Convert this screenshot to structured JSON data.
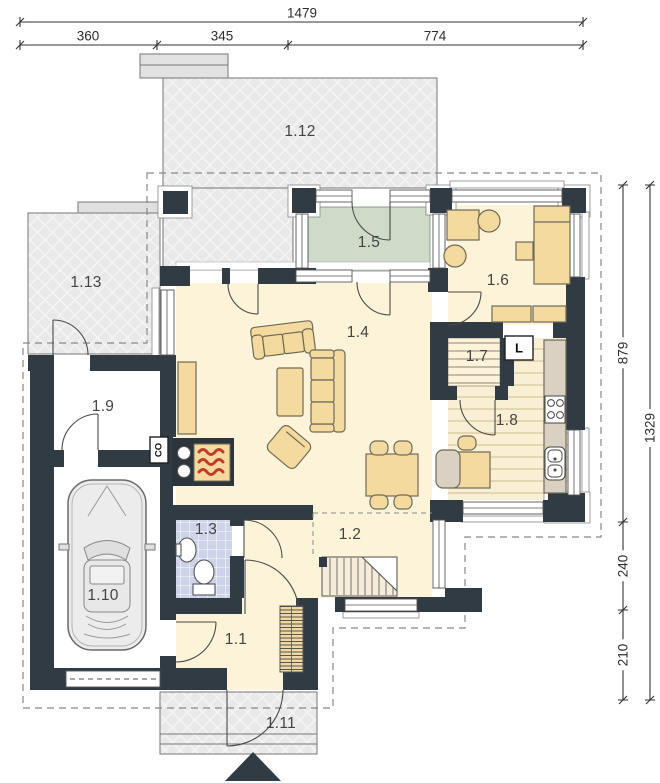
{
  "rooms": {
    "r1_1": "1.1",
    "r1_2": "1.2",
    "r1_3": "1.3",
    "r1_4": "1.4",
    "r1_5": "1.5",
    "r1_6": "1.6",
    "r1_7": "1.7",
    "r1_8": "1.8",
    "r1_9": "1.9",
    "r1_10": "1.10",
    "r1_11": "1.11",
    "r1_12": "1.12",
    "r1_13": "1.13"
  },
  "appliances": {
    "fridge": "L",
    "boiler": "CO"
  },
  "dimensions": {
    "top": {
      "total": "1479",
      "segments": [
        "360",
        "345",
        "774"
      ]
    },
    "right": {
      "total": "1329",
      "segments": [
        "879",
        "240",
        "210"
      ]
    }
  },
  "colors": {
    "wall": "#313b44",
    "floor": "#fdf3d8",
    "terrace": "#e9e9e9",
    "conservatory": "#cedbc9",
    "bathroom": "#cdd3e9",
    "furniture": "#f4da9f",
    "flame": "#c23b2a"
  }
}
